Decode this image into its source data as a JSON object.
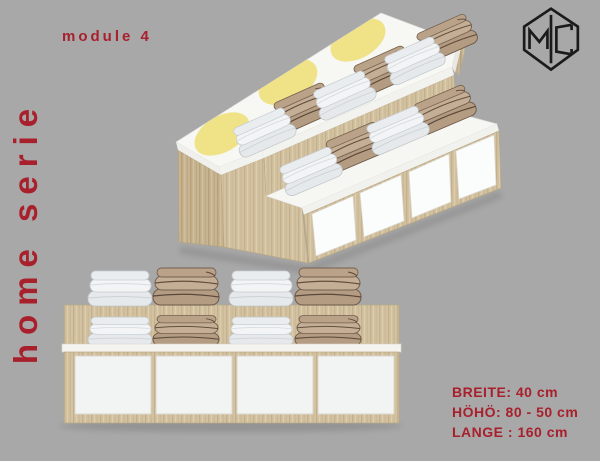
{
  "title_block": {
    "module_label": "module 4",
    "series_label": "home serie"
  },
  "brand": {
    "logo_monogram": "MC"
  },
  "specs": {
    "width": "BREITE: 40 cm",
    "height": "HÖHÖ: 80 - 50 cm",
    "length": "LANGE : 160 cm"
  },
  "colors": {
    "background": "#a8a8a8",
    "accent_red": "#a8202c",
    "wood": "#d3c2a2",
    "yellow_decal": "#eee07b",
    "logo_black": "#1b1b1b"
  }
}
